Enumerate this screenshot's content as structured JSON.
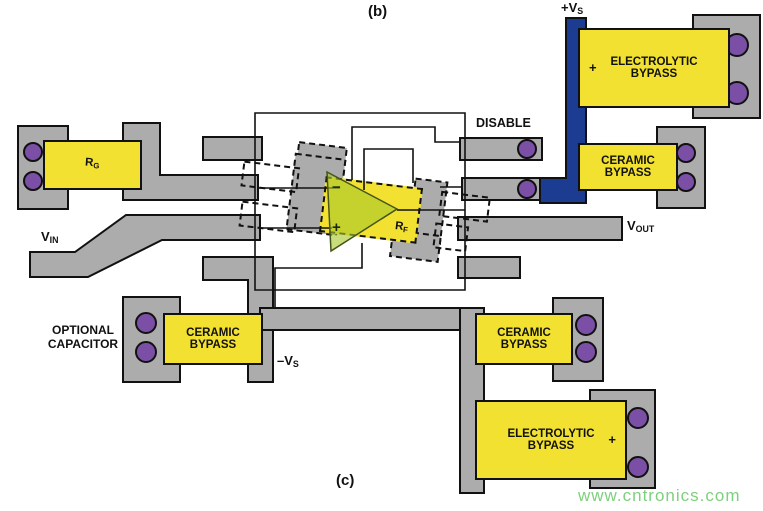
{
  "figure": {
    "panel_top": "(b)",
    "panel_bottom": "(c)",
    "watermark": "www.cntronics.com"
  },
  "power": {
    "pos_rail_main": "+V",
    "pos_rail_sub": "S",
    "neg_rail_main": "–V",
    "neg_rail_sub": "S"
  },
  "signals": {
    "vin_main": "V",
    "vin_sub": "IN",
    "vout_main": "V",
    "vout_sub": "OUT",
    "disable": "DISABLE"
  },
  "resistors": {
    "rg_main": "R",
    "rg_sub": "G",
    "rf_main": "R",
    "rf_sub": "F"
  },
  "opamp": {
    "inverting_mark": "−",
    "noninverting_mark": "+"
  },
  "capacitors": {
    "electrolytic_top": {
      "line1": "ELECTROLYTIC",
      "line2": "BYPASS",
      "polarity": "+"
    },
    "ceramic_top_right": {
      "line1": "CERAMIC",
      "line2": "BYPASS"
    },
    "ceramic_bottom_left": {
      "line1": "CERAMIC",
      "line2": "BYPASS"
    },
    "ceramic_bottom_right": {
      "line1": "CERAMIC",
      "line2": "BYPASS"
    },
    "electrolytic_bottom": {
      "line1": "ELECTROLYTIC",
      "line2": "BYPASS",
      "polarity": "+"
    },
    "optional_note_line1": "OPTIONAL",
    "optional_note_line2": "CAPACITOR"
  },
  "colors": {
    "trace_gray": "#ACACAC",
    "power_blue": "#1C3C92",
    "component_yellow": "#F2E130",
    "via_purple": "#7B4FA6",
    "opamp_green": "#AAC82D",
    "watermark_green": "#7ECF7E",
    "background": "#FFFFFF"
  }
}
